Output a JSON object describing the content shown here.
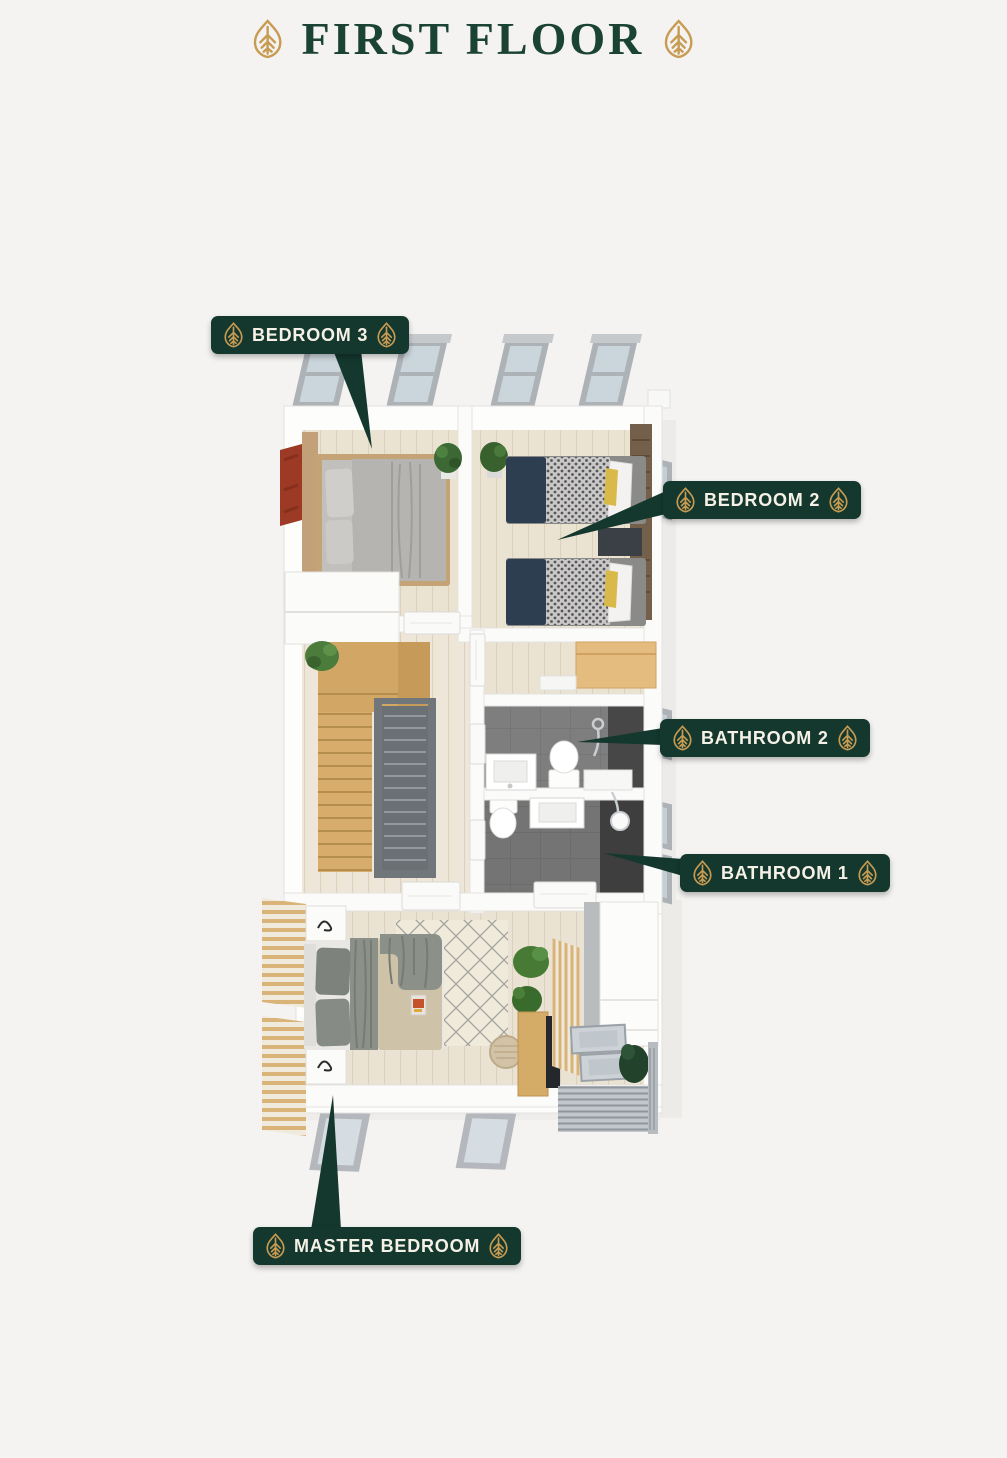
{
  "header": {
    "title": "FIRST FLOOR"
  },
  "labels": [
    {
      "id": "bedroom-3",
      "text": "BEDROOM 3"
    },
    {
      "id": "bedroom-2",
      "text": "BEDROOM 2"
    },
    {
      "id": "bathroom-2",
      "text": "BATHROOM 2"
    },
    {
      "id": "bathroom-1",
      "text": "BATHROOM 1"
    },
    {
      "id": "master-bedroom",
      "text": "MASTER BEDROOM"
    }
  ],
  "icons": {
    "decorative": "leaf-icon"
  },
  "colors": {
    "background": "#F4F3F1",
    "badge_green": "#14382E",
    "title_green": "#1A4336",
    "gold_accent": "#C79B52",
    "badge_text": "#F6F1E6"
  }
}
